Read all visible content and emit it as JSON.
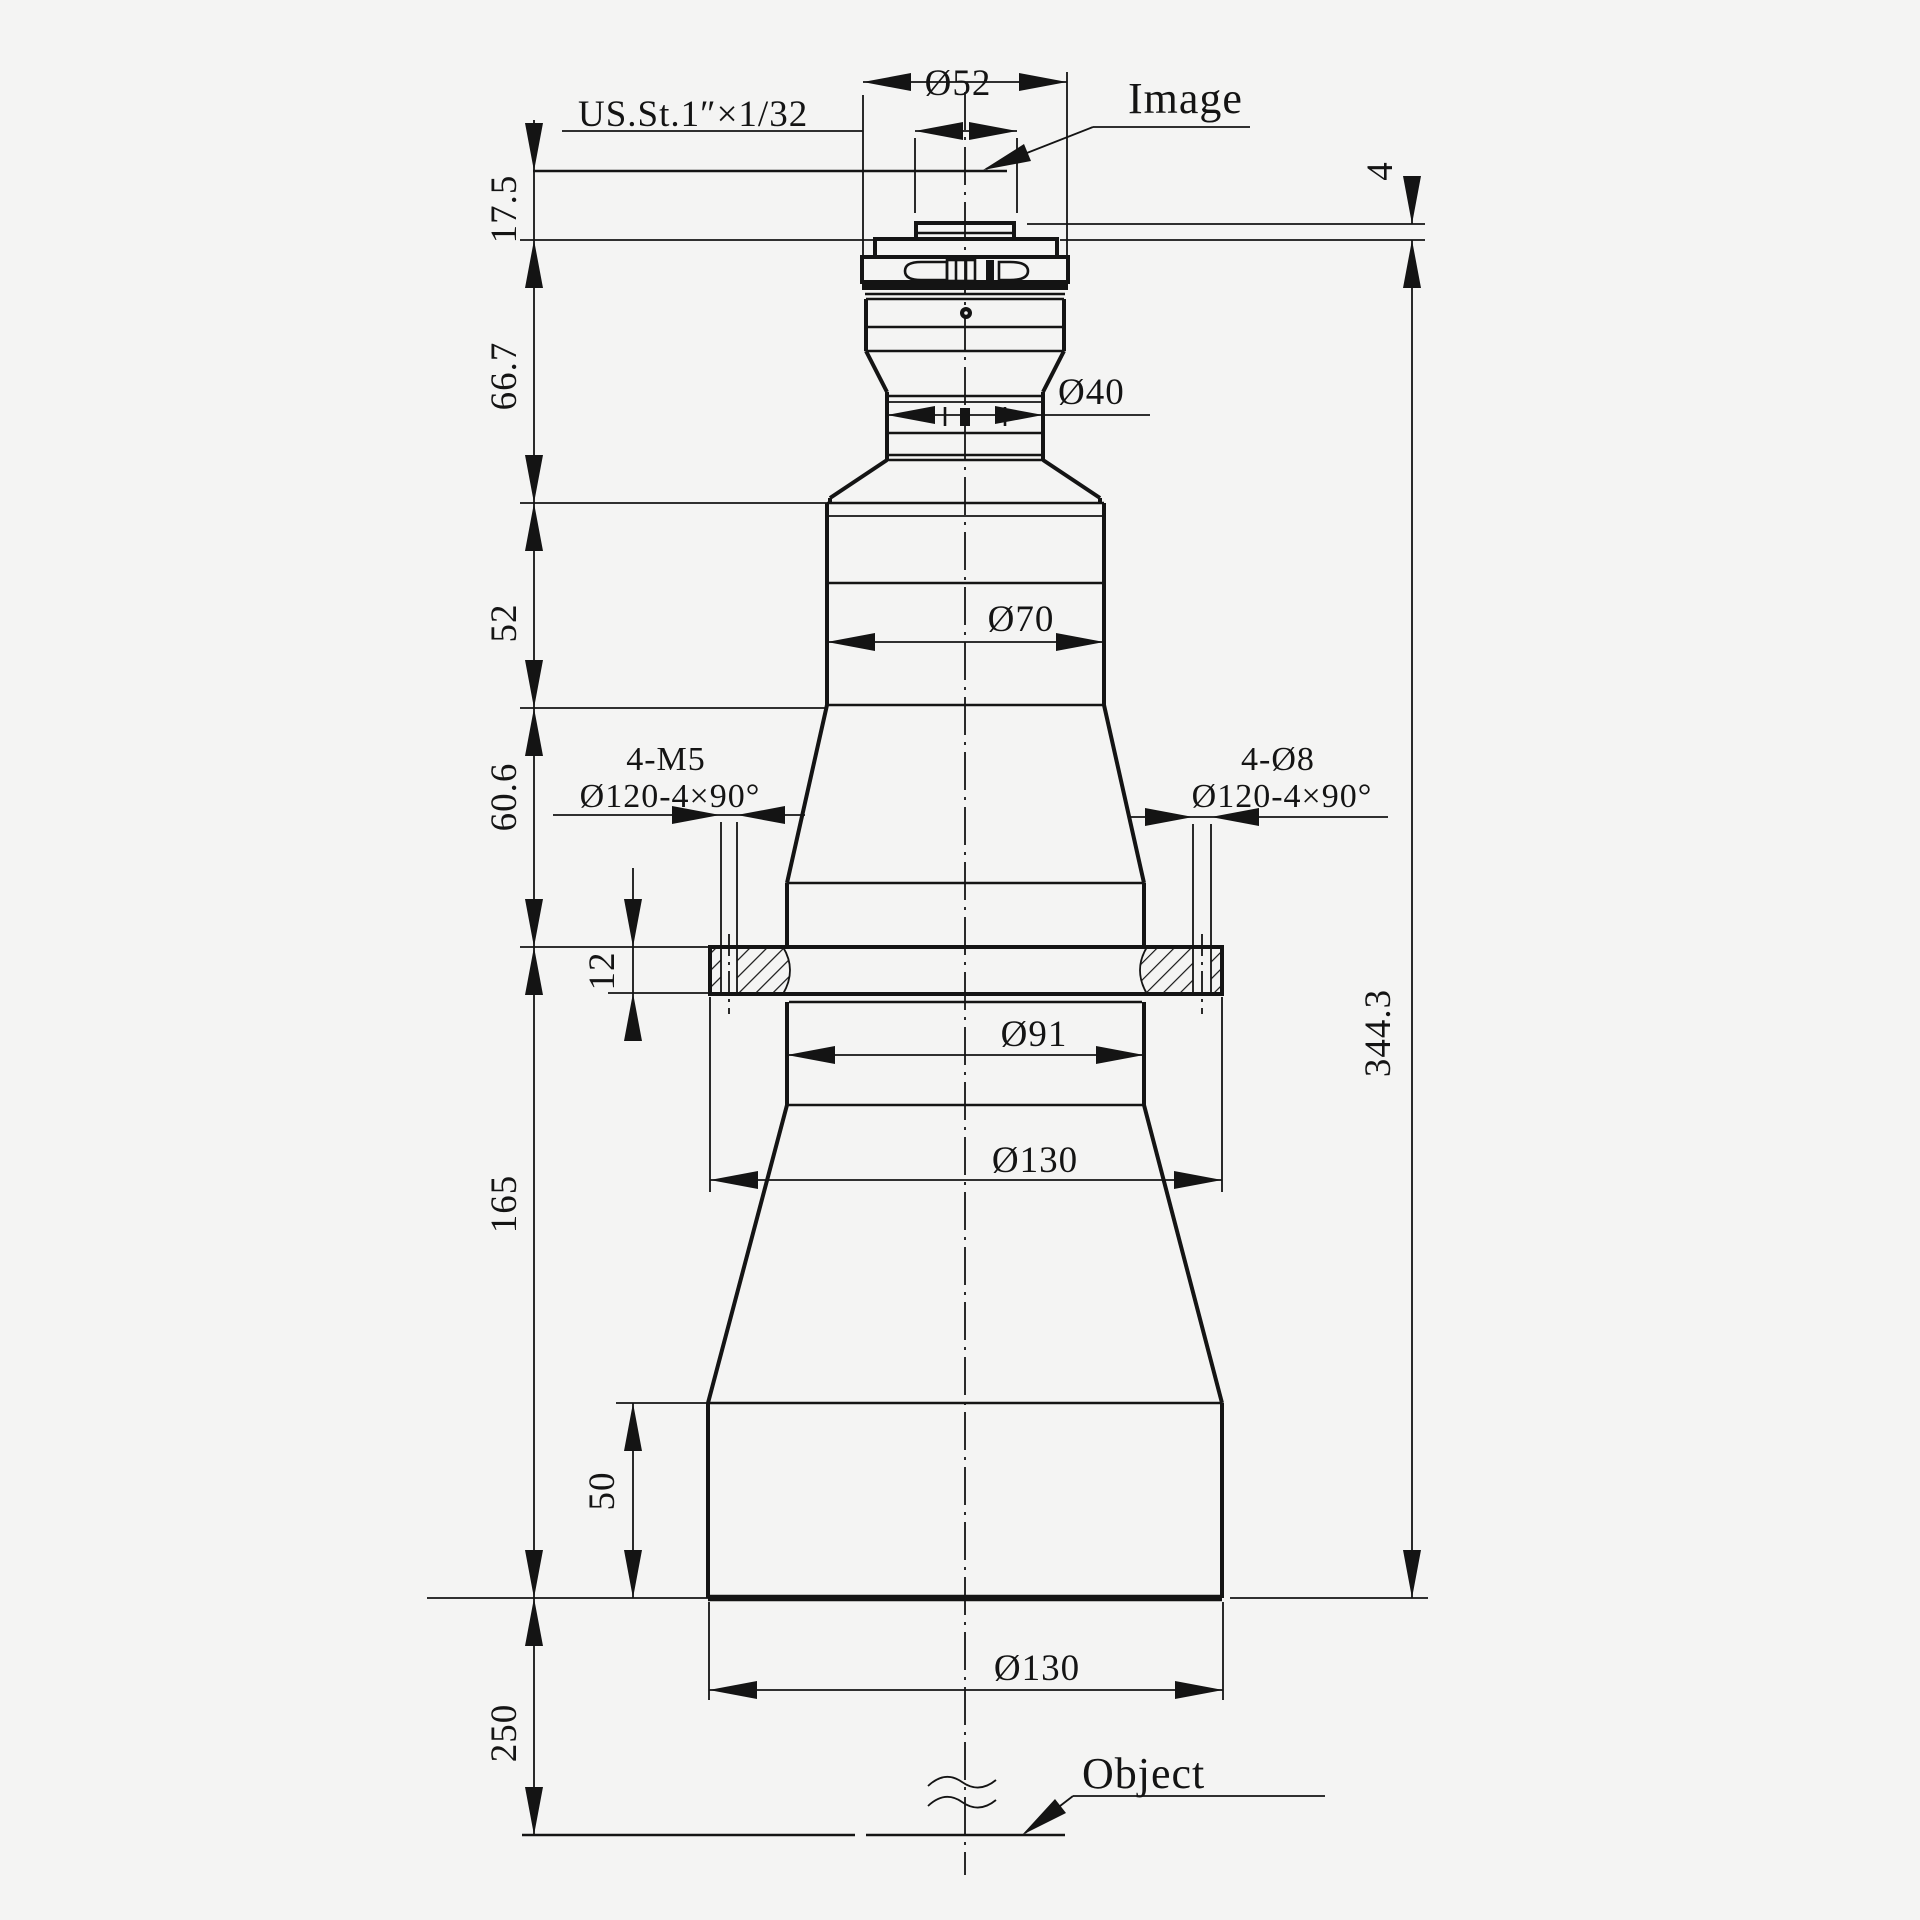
{
  "colors": {
    "background": "#f4f4f3",
    "line": "#141414"
  },
  "labels": {
    "image": "Image",
    "object": "Object",
    "thread": "US.St.1″×1/32"
  },
  "dims": {
    "dia52": "Ø52",
    "dia40": "Ø40",
    "dia70": "Ø70",
    "dia91": "Ø91",
    "dia130_mid": "Ø130",
    "dia130_base": "Ø130",
    "v17_5": "17.5",
    "v4": "4",
    "v66_7": "66.7",
    "v52": "52",
    "v60_6": "60.6",
    "v12": "12",
    "v165": "165",
    "v344_3": "344.3",
    "v50": "50",
    "v250": "250"
  },
  "holes": {
    "left_count": "4-M5",
    "left_circle": "Ø120-4×90°",
    "right_count": "4-Ø8",
    "right_circle": "Ø120-4×90°"
  }
}
